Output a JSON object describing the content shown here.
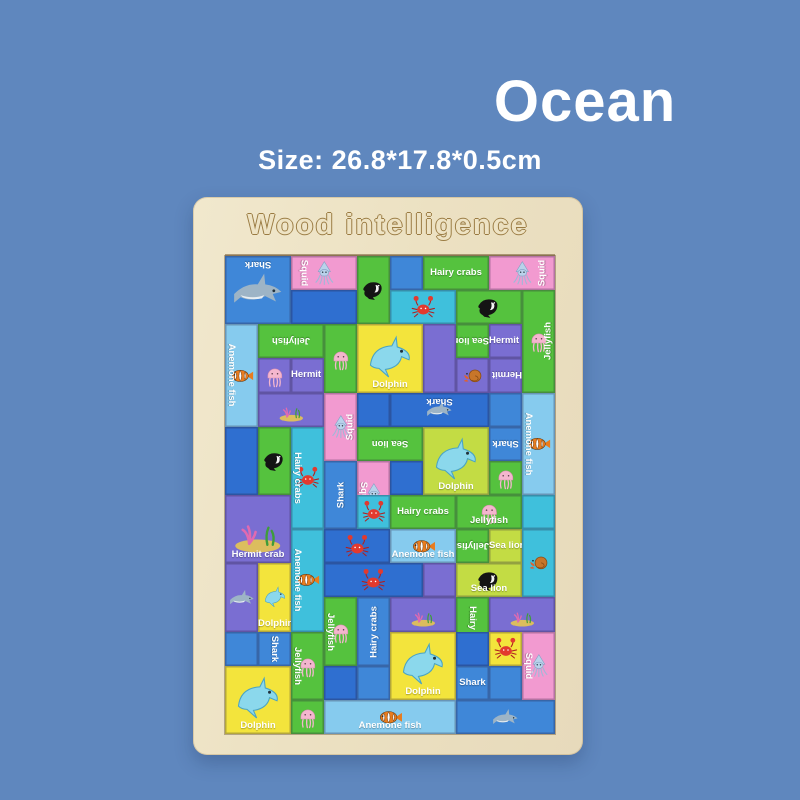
{
  "title": "Ocean",
  "size_text": "Size: 26.8*17.8*0.5cm",
  "board": {
    "brand": "Wood intelligence",
    "wood_color": "#ece1c2"
  },
  "background_color": "#5f87be",
  "puzzle": {
    "unit_x": 33,
    "unit_y": 34.142857,
    "cols": 10,
    "rows": 14,
    "palette": {
      "blue": "#3f87d8",
      "deepblue": "#2f6fd0",
      "pink": "#f29ad0",
      "green": "#55c23e",
      "yellowgreen": "#c3dc44",
      "cyan": "#3fc0dc",
      "lightblue": "#86cbee",
      "yellow": "#f3e43c",
      "purple": "#7a6ed2"
    },
    "animal_names": [
      "shark",
      "squid",
      "crab",
      "jellyfish",
      "dolphin",
      "seal",
      "clownfish",
      "hermit",
      "seabed"
    ],
    "tiles": [
      {
        "x": 0,
        "y": 0,
        "w": 2,
        "h": 2,
        "c": "blue",
        "label": "Shark",
        "lo": "h180",
        "a": "shark",
        "b": 1
      },
      {
        "x": 2,
        "y": 0,
        "w": 2,
        "h": 1,
        "c": "pink",
        "label": "Squid",
        "lo": "v",
        "a": "squid"
      },
      {
        "x": 4,
        "y": 0,
        "w": 1,
        "h": 2,
        "c": "green",
        "a": "seal"
      },
      {
        "x": 5,
        "y": 0,
        "w": 1,
        "h": 1,
        "c": "blue",
        "b": 1
      },
      {
        "x": 6,
        "y": 0,
        "w": 2,
        "h": 1,
        "c": "green",
        "label": "Hairy crabs",
        "lo": "h"
      },
      {
        "x": 8,
        "y": 0,
        "w": 2,
        "h": 1,
        "c": "pink",
        "label": "Squid",
        "lo": "v180",
        "a": "squid"
      },
      {
        "x": 2,
        "y": 1,
        "w": 2,
        "h": 1,
        "c": "deepblue",
        "b": 1
      },
      {
        "x": 5,
        "y": 1,
        "w": 2,
        "h": 1,
        "c": "cyan",
        "a": "crab"
      },
      {
        "x": 7,
        "y": 1,
        "w": 2,
        "h": 1,
        "c": "green",
        "a": "seal"
      },
      {
        "x": 9,
        "y": 1,
        "w": 1,
        "h": 3,
        "c": "green",
        "label": "Jellyfish",
        "lo": "v180",
        "a": "jellyfish"
      },
      {
        "x": 0,
        "y": 2,
        "w": 1,
        "h": 3,
        "c": "lightblue",
        "label": "Anemone fish",
        "lo": "v",
        "a": "clownfish"
      },
      {
        "x": 1,
        "y": 2,
        "w": 2,
        "h": 1,
        "c": "green",
        "label": "Jellyfish",
        "lo": "h180"
      },
      {
        "x": 3,
        "y": 2,
        "w": 1,
        "h": 2,
        "c": "green",
        "a": "jellyfish"
      },
      {
        "x": 4,
        "y": 2,
        "w": 2,
        "h": 2,
        "c": "yellow",
        "label": "Dolphin",
        "lo": "h",
        "a": "dolphin"
      },
      {
        "x": 6,
        "y": 2,
        "w": 1,
        "h": 2,
        "c": "purple",
        "b": 1
      },
      {
        "x": 7,
        "y": 2,
        "w": 1,
        "h": 1,
        "c": "green",
        "label": "Sea lion",
        "lo": "h180"
      },
      {
        "x": 8,
        "y": 2,
        "w": 1,
        "h": 1,
        "c": "purple",
        "label": "Hermit crab",
        "lo": "h"
      },
      {
        "x": 1,
        "y": 3,
        "w": 1,
        "h": 1,
        "c": "purple",
        "a": "jellyfish"
      },
      {
        "x": 2,
        "y": 3,
        "w": 1,
        "h": 1,
        "c": "purple",
        "label": "Hermit crab",
        "lo": "h"
      },
      {
        "x": 7,
        "y": 3,
        "w": 1,
        "h": 1,
        "c": "purple",
        "a": "hermit"
      },
      {
        "x": 8,
        "y": 3,
        "w": 1,
        "h": 1,
        "c": "purple",
        "label": "Hermit crab",
        "lo": "h180"
      },
      {
        "x": 1,
        "y": 4,
        "w": 2,
        "h": 1,
        "c": "purple",
        "a": "seabed"
      },
      {
        "x": 3,
        "y": 4,
        "w": 1,
        "h": 2,
        "c": "pink",
        "label": "Squid",
        "lo": "v180",
        "a": "squid"
      },
      {
        "x": 4,
        "y": 4,
        "w": 1,
        "h": 1,
        "c": "deepblue",
        "b": 1
      },
      {
        "x": 5,
        "y": 4,
        "w": 3,
        "h": 1,
        "c": "deepblue",
        "label": "Shark",
        "lo": "h180",
        "a": "shark",
        "b": 1
      },
      {
        "x": 8,
        "y": 4,
        "w": 1,
        "h": 1,
        "c": "blue",
        "b": 1
      },
      {
        "x": 9,
        "y": 4,
        "w": 1,
        "h": 3,
        "c": "lightblue",
        "label": "Anemone fish",
        "lo": "v",
        "a": "clownfish"
      },
      {
        "x": 0,
        "y": 5,
        "w": 1,
        "h": 2,
        "c": "deepblue",
        "b": 1
      },
      {
        "x": 1,
        "y": 5,
        "w": 1,
        "h": 2,
        "c": "green",
        "a": "seal"
      },
      {
        "x": 2,
        "y": 5,
        "w": 1,
        "h": 3,
        "c": "cyan",
        "label": "Hairy crabs",
        "lo": "v",
        "a": "crab"
      },
      {
        "x": 4,
        "y": 5,
        "w": 2,
        "h": 1,
        "c": "green",
        "label": "Sea lion",
        "lo": "h180"
      },
      {
        "x": 6,
        "y": 5,
        "w": 2,
        "h": 2,
        "c": "yellowgreen",
        "label": "Dolphin",
        "lo": "h",
        "a": "dolphin"
      },
      {
        "x": 8,
        "y": 5,
        "w": 1,
        "h": 1,
        "c": "blue",
        "label": "Shark",
        "lo": "h180"
      },
      {
        "x": 3,
        "y": 6,
        "w": 1,
        "h": 2,
        "c": "blue",
        "label": "Shark",
        "lo": "v180"
      },
      {
        "x": 4,
        "y": 6,
        "w": 1,
        "h": 2,
        "c": "pink",
        "label": "Squid",
        "lo": "v",
        "a": "squid"
      },
      {
        "x": 5,
        "y": 6,
        "w": 1,
        "h": 1,
        "c": "deepblue",
        "b": 1
      },
      {
        "x": 8,
        "y": 6,
        "w": 1,
        "h": 1,
        "c": "green",
        "a": "jellyfish"
      },
      {
        "x": 0,
        "y": 7,
        "w": 2,
        "h": 2,
        "c": "purple",
        "label": "Hermit crab",
        "lo": "h",
        "a": "seabed"
      },
      {
        "x": 4,
        "y": 7,
        "w": 1,
        "h": 1,
        "c": "cyan",
        "a": "crab"
      },
      {
        "x": 5,
        "y": 7,
        "w": 2,
        "h": 1,
        "c": "green",
        "label": "Hairy crabs",
        "lo": "h"
      },
      {
        "x": 7,
        "y": 7,
        "w": 2,
        "h": 1,
        "c": "green",
        "label": "Jellyfish",
        "lo": "h",
        "a": "jellyfish"
      },
      {
        "x": 9,
        "y": 7,
        "w": 1,
        "h": 1,
        "c": "cyan",
        "b": 1
      },
      {
        "x": 2,
        "y": 8,
        "w": 1,
        "h": 3,
        "c": "cyan",
        "label": "Anemone fish",
        "lo": "v",
        "a": "clownfish"
      },
      {
        "x": 3,
        "y": 8,
        "w": 2,
        "h": 1,
        "c": "deepblue",
        "a": "crab",
        "b": 1
      },
      {
        "x": 5,
        "y": 8,
        "w": 2,
        "h": 1,
        "c": "lightblue",
        "label": "Anemone fish",
        "lo": "h",
        "a": "clownfish"
      },
      {
        "x": 7,
        "y": 8,
        "w": 1,
        "h": 1,
        "c": "green",
        "label": "Jellyfish",
        "lo": "h180"
      },
      {
        "x": 8,
        "y": 8,
        "w": 1,
        "h": 1,
        "c": "yellowgreen",
        "label": "Sea lion",
        "lo": "h"
      },
      {
        "x": 9,
        "y": 8,
        "w": 1,
        "h": 2,
        "c": "cyan",
        "a": "hermit"
      },
      {
        "x": 0,
        "y": 9,
        "w": 1,
        "h": 2,
        "c": "purple",
        "a": "shark"
      },
      {
        "x": 1,
        "y": 9,
        "w": 1,
        "h": 2,
        "c": "yellow",
        "label": "Dolphin",
        "lo": "h",
        "a": "dolphin"
      },
      {
        "x": 3,
        "y": 9,
        "w": 3,
        "h": 1,
        "c": "deepblue",
        "a": "crab",
        "b": 1
      },
      {
        "x": 6,
        "y": 9,
        "w": 1,
        "h": 1,
        "c": "purple",
        "b": 1
      },
      {
        "x": 7,
        "y": 9,
        "w": 2,
        "h": 1,
        "c": "yellowgreen",
        "label": "Sea lion",
        "lo": "h",
        "a": "seal"
      },
      {
        "x": 3,
        "y": 10,
        "w": 1,
        "h": 2,
        "c": "green",
        "label": "Jellyfish",
        "lo": "v",
        "a": "jellyfish"
      },
      {
        "x": 4,
        "y": 10,
        "w": 1,
        "h": 2,
        "c": "blue",
        "label": "Hairy crabs",
        "lo": "v180"
      },
      {
        "x": 5,
        "y": 10,
        "w": 2,
        "h": 1,
        "c": "purple",
        "a": "seabed"
      },
      {
        "x": 7,
        "y": 10,
        "w": 1,
        "h": 2,
        "c": "green",
        "label": "Hairy crabs",
        "lo": "v"
      },
      {
        "x": 8,
        "y": 10,
        "w": 2,
        "h": 1,
        "c": "purple",
        "a": "seabed"
      },
      {
        "x": 0,
        "y": 11,
        "w": 1,
        "h": 1,
        "c": "blue",
        "b": 1
      },
      {
        "x": 1,
        "y": 11,
        "w": 1,
        "h": 1,
        "c": "blue",
        "label": "Shark",
        "lo": "v"
      },
      {
        "x": 2,
        "y": 11,
        "w": 1,
        "h": 2,
        "c": "green",
        "label": "Jellyfish",
        "lo": "v",
        "a": "jellyfish"
      },
      {
        "x": 5,
        "y": 11,
        "w": 2,
        "h": 2,
        "c": "yellow",
        "label": "Dolphin",
        "lo": "h",
        "a": "dolphin"
      },
      {
        "x": 7,
        "y": 11,
        "w": 1,
        "h": 1,
        "c": "deepblue",
        "b": 1
      },
      {
        "x": 8,
        "y": 11,
        "w": 1,
        "h": 1,
        "c": "yellow",
        "a": "crab"
      },
      {
        "x": 9,
        "y": 11,
        "w": 1,
        "h": 2,
        "c": "pink",
        "label": "Squid",
        "lo": "v",
        "a": "squid"
      },
      {
        "x": 0,
        "y": 12,
        "w": 2,
        "h": 2,
        "c": "yellow",
        "label": "Dolphin",
        "lo": "h",
        "a": "dolphin"
      },
      {
        "x": 3,
        "y": 12,
        "w": 1,
        "h": 1,
        "c": "deepblue",
        "b": 1
      },
      {
        "x": 4,
        "y": 12,
        "w": 1,
        "h": 1,
        "c": "blue",
        "b": 1
      },
      {
        "x": 7,
        "y": 12,
        "w": 1,
        "h": 1,
        "c": "blue",
        "label": "Shark",
        "lo": "h"
      },
      {
        "x": 8,
        "y": 12,
        "w": 1,
        "h": 1,
        "c": "blue",
        "b": 1
      },
      {
        "x": 2,
        "y": 13,
        "w": 1,
        "h": 1,
        "c": "green",
        "a": "jellyfish"
      },
      {
        "x": 3,
        "y": 13,
        "w": 4,
        "h": 1,
        "c": "lightblue",
        "label": "Anemone fish",
        "lo": "h",
        "a": "clownfish"
      },
      {
        "x": 7,
        "y": 13,
        "w": 3,
        "h": 1,
        "c": "blue",
        "a": "shark",
        "b": 1
      }
    ]
  }
}
